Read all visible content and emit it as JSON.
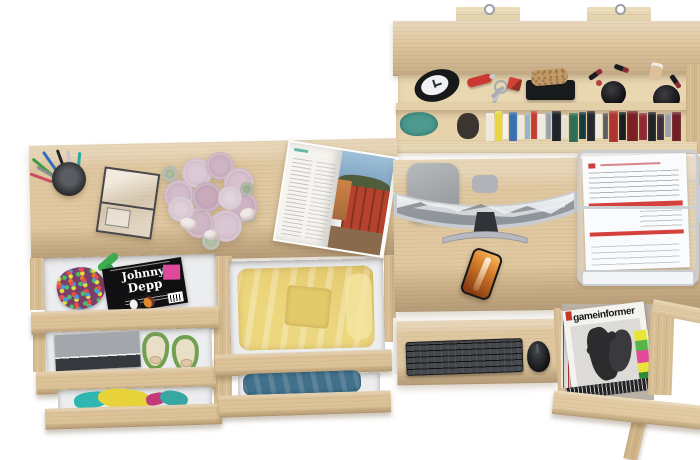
{
  "scene": {
    "background": "#ffffff",
    "wood_color": "#dfc7a0",
    "accent_red": "#d4403c",
    "accent_green": "#72a050",
    "accent_yellow": "#edd77e",
    "accent_blue_jeans": "#41718c"
  },
  "shelf": {
    "books": [
      {
        "c": "#efe9da",
        "w": 8,
        "h": 28,
        "m": 2
      },
      {
        "c": "#e6d83e",
        "w": 7,
        "h": 30,
        "m": 0
      },
      {
        "c": "#f4f1e8",
        "w": 5,
        "h": 25,
        "m": 3
      },
      {
        "c": "#3a6fb0",
        "w": 8,
        "h": 29,
        "m": 1
      },
      {
        "c": "#ece8dd",
        "w": 6,
        "h": 24,
        "m": 4
      },
      {
        "c": "#8fb3d4",
        "w": 5,
        "h": 26,
        "m": 2
      },
      {
        "c": "#c23b35",
        "w": 6,
        "h": 28,
        "m": 0
      },
      {
        "c": "#f0ebe0",
        "w": 7,
        "h": 25,
        "m": 3
      },
      {
        "c": "#9aa0a5",
        "w": 5,
        "h": 27,
        "m": 1
      },
      {
        "c": "#1f2226",
        "w": 9,
        "h": 30,
        "m": 0
      },
      {
        "c": "#e4e0d4",
        "w": 6,
        "h": 23,
        "m": 4
      },
      {
        "c": "#2f6d52",
        "w": 9,
        "h": 29,
        "m": 2
      },
      {
        "c": "#133c41",
        "w": 7,
        "h": 27,
        "m": 1
      },
      {
        "c": "#24272b",
        "w": 8,
        "h": 30,
        "m": 0
      },
      {
        "c": "#eeeadf",
        "w": 6,
        "h": 24,
        "m": 3
      },
      {
        "c": "#585d62",
        "w": 5,
        "h": 26,
        "m": 2
      },
      {
        "c": "#ae3332",
        "w": 9,
        "h": 31,
        "m": 0
      },
      {
        "c": "#1a1d20",
        "w": 7,
        "h": 28,
        "m": 1
      },
      {
        "c": "#7c2026",
        "w": 11,
        "h": 30,
        "m": 0
      },
      {
        "c": "#8e2b32",
        "w": 8,
        "h": 27,
        "m": 2
      },
      {
        "c": "#202327",
        "w": 8,
        "h": 29,
        "m": 1
      },
      {
        "c": "#3b2e40",
        "w": 7,
        "h": 26,
        "m": 3
      },
      {
        "c": "#9ba0a5",
        "w": 6,
        "h": 24,
        "m": 2
      },
      {
        "c": "#6f2026",
        "w": 9,
        "h": 29,
        "m": 1
      }
    ]
  },
  "left_desk": {
    "pens": [
      {
        "x": 10,
        "y": 4,
        "h": 30,
        "r": -50,
        "c": "#3f9b46"
      },
      {
        "x": 16,
        "y": 2,
        "h": 32,
        "r": -35,
        "c": "#2f6fbe"
      },
      {
        "x": 22,
        "y": 4,
        "h": 30,
        "r": -20,
        "c": "#23262a"
      },
      {
        "x": 27,
        "y": 6,
        "h": 28,
        "r": -10,
        "c": "#c2c6ca"
      },
      {
        "x": 32,
        "y": 8,
        "h": 26,
        "r": 5,
        "c": "#2aa7a0"
      },
      {
        "x": 14,
        "y": 10,
        "h": 26,
        "r": -60,
        "c": "#8a8f94"
      },
      {
        "x": 7,
        "y": 14,
        "h": 24,
        "r": -70,
        "c": "#cd4f63"
      }
    ],
    "roses": [
      {
        "x": 2,
        "y": 28,
        "d": 30,
        "c": "#d3bccb"
      },
      {
        "x": 20,
        "y": 6,
        "d": 30,
        "c": "#dcc9d6"
      },
      {
        "x": 44,
        "y": 0,
        "d": 28,
        "c": "#cfb4c4"
      },
      {
        "x": 62,
        "y": 16,
        "d": 30,
        "c": "#d8c2d0"
      },
      {
        "x": 66,
        "y": 40,
        "d": 30,
        "c": "#cdb2c2"
      },
      {
        "x": 48,
        "y": 58,
        "d": 32,
        "c": "#dac6d3"
      },
      {
        "x": 22,
        "y": 56,
        "d": 30,
        "c": "#d0b7c6"
      },
      {
        "x": 6,
        "y": 44,
        "d": 26,
        "c": "#e0d0da"
      },
      {
        "x": 30,
        "y": 30,
        "d": 30,
        "c": "#c9abbc"
      },
      {
        "x": 56,
        "y": 34,
        "d": 24,
        "c": "#e3d5dd"
      },
      {
        "x": 0,
        "y": 14,
        "d": 16,
        "c": "#aebfa0"
      },
      {
        "x": 78,
        "y": 30,
        "d": 14,
        "c": "#a3b796"
      },
      {
        "x": 40,
        "y": 80,
        "d": 18,
        "c": "#b5c4a8"
      },
      {
        "x": 82,
        "y": 58,
        "d": 12,
        "c": "#9fb392"
      }
    ],
    "drawer1_magazine": {
      "line1": "Johnny",
      "line2": "Depp"
    }
  },
  "magazine_rack": {
    "magazine_title": "gameinformer"
  }
}
